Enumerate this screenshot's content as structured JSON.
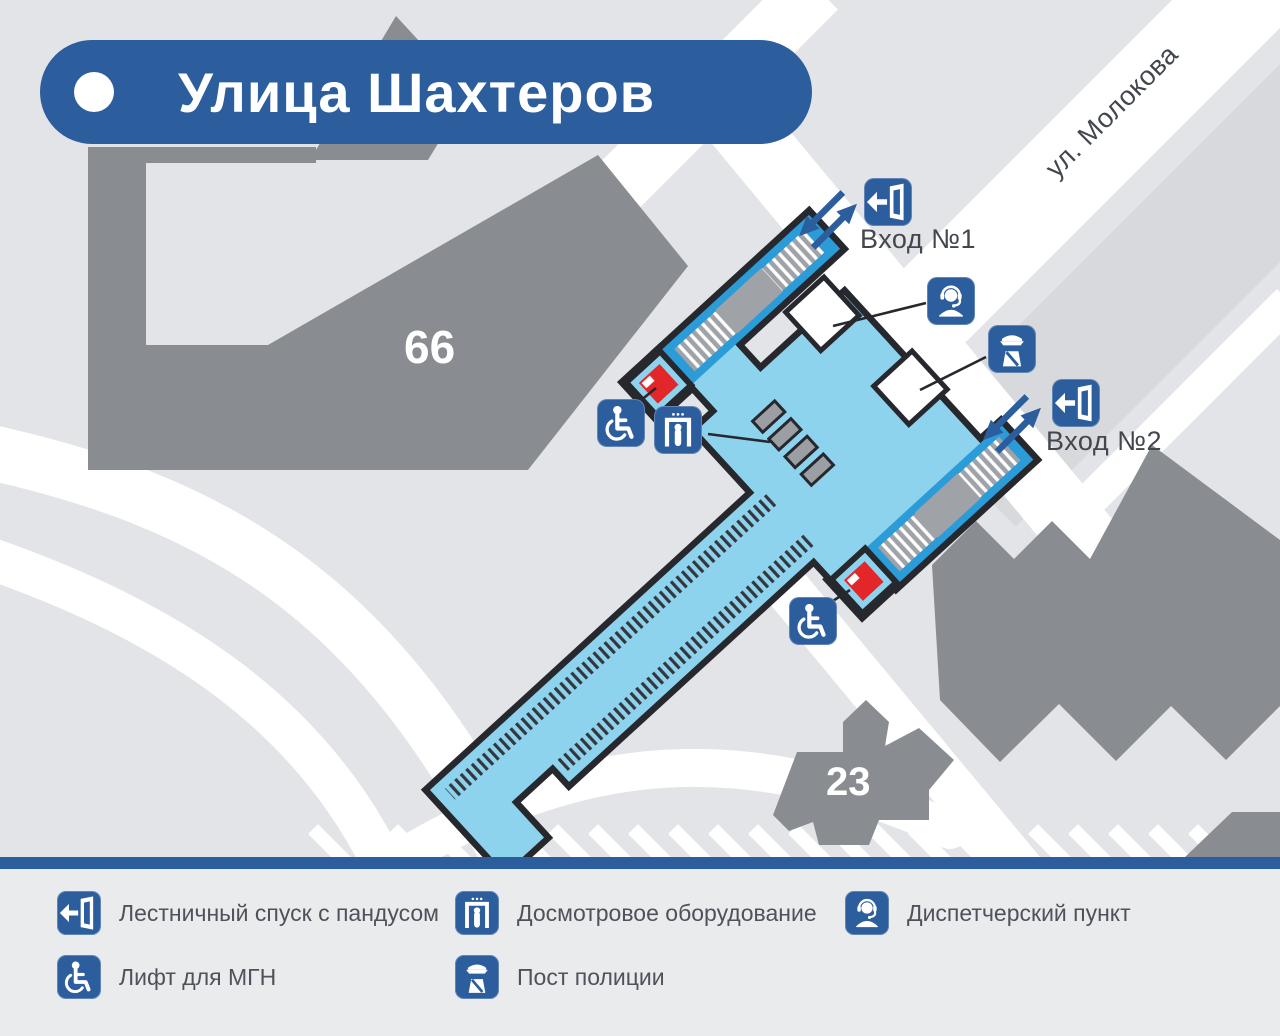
{
  "title": {
    "station_name": "Улица Шахтеров"
  },
  "map": {
    "street_label": "ул. Молокова",
    "building_66": "66",
    "building_23": "23",
    "entrance1_label": "Вход №1",
    "entrance2_label": "Вход №2"
  },
  "legend": {
    "items": [
      {
        "icon": "stairs-exit-icon",
        "label": "Лестничный спуск с пандусом"
      },
      {
        "icon": "security-scanner-icon",
        "label": "Досмотровое оборудование"
      },
      {
        "icon": "dispatcher-icon",
        "label": "Диспетчерский пункт"
      },
      {
        "icon": "wheelchair-lift-icon",
        "label": "Лифт для МГН"
      },
      {
        "icon": "police-post-icon",
        "label": "Пост полиции"
      }
    ]
  },
  "colors": {
    "accent_blue": "#2c5d9c",
    "station_fill": "#8ed3ee",
    "stairs_blue": "#2b9cd8",
    "lift_red": "#e2262a",
    "building_gray": "#898c91",
    "background": "#e3e4e7",
    "road_white": "#ffffff"
  }
}
